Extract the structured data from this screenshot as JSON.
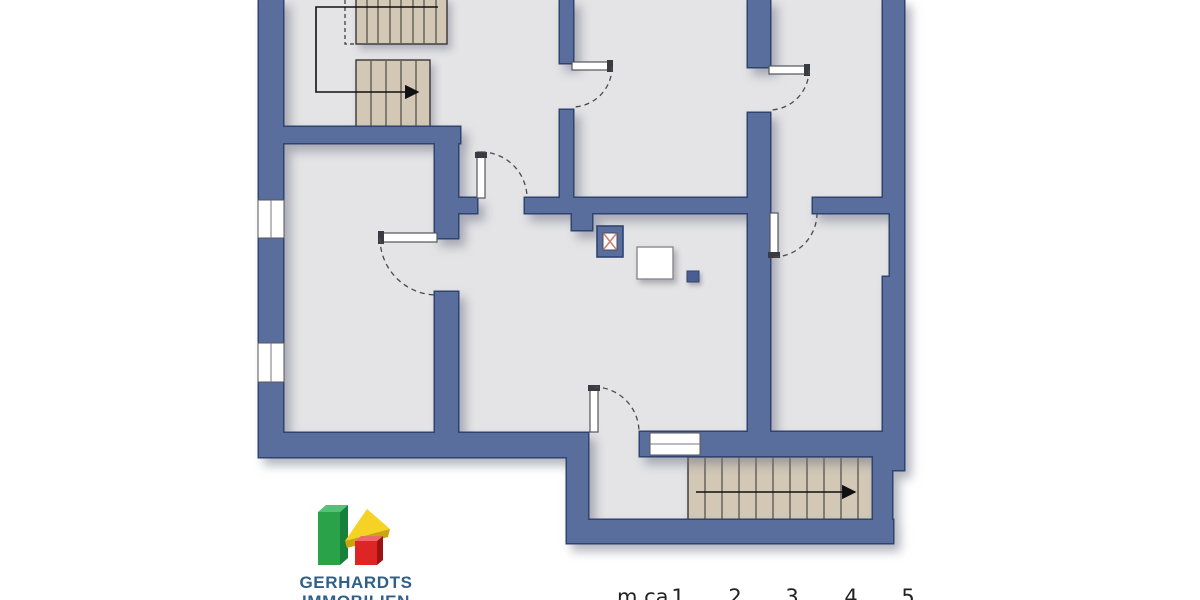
{
  "page": {
    "background": "#ffffff"
  },
  "palette": {
    "wall-fill": "#5a6e9e",
    "wall-stroke": "#2e4470",
    "floor": "#e4e4e6",
    "stair-fill": "#d3c8b6",
    "stair-line": "#33302b",
    "door-leaf": "#ffffff",
    "door-line": "#53545c",
    "arc": "#4a4a4a",
    "walkline": "#111111",
    "window-line": "#77777d",
    "chimney-hatch": "#cc8274",
    "accent-square": "#4a5f91",
    "logo-green": "#2aa24a",
    "logo-green-dark": "#17813a",
    "logo-green-light": "#56c176",
    "logo-yellow": "#f6d224",
    "logo-yellow-dark": "#c9a50e",
    "logo-red": "#dd2525",
    "logo-red-dark": "#9c1313",
    "logo-red-light": "#ee6a6a",
    "logo-text": "#305f88",
    "scale-text": "#222222"
  },
  "logo": {
    "line1": "GERHARDTS",
    "line2": "IMMOBILIEN"
  },
  "scale_bar": {
    "unit_label": "m ca.",
    "marks": [
      "1",
      "2",
      "3",
      "4",
      "5"
    ]
  },
  "plan": {
    "type": "floor-plan",
    "features": [
      "exterior-walls",
      "interior-walls",
      "staircase-upper-left-two-flights",
      "staircase-lower-right",
      "stair-walk-lines-with-arrows",
      "door-swings-6",
      "windows-3",
      "chimney",
      "shaft",
      "wall-pillar",
      "small-duct-marker"
    ]
  }
}
